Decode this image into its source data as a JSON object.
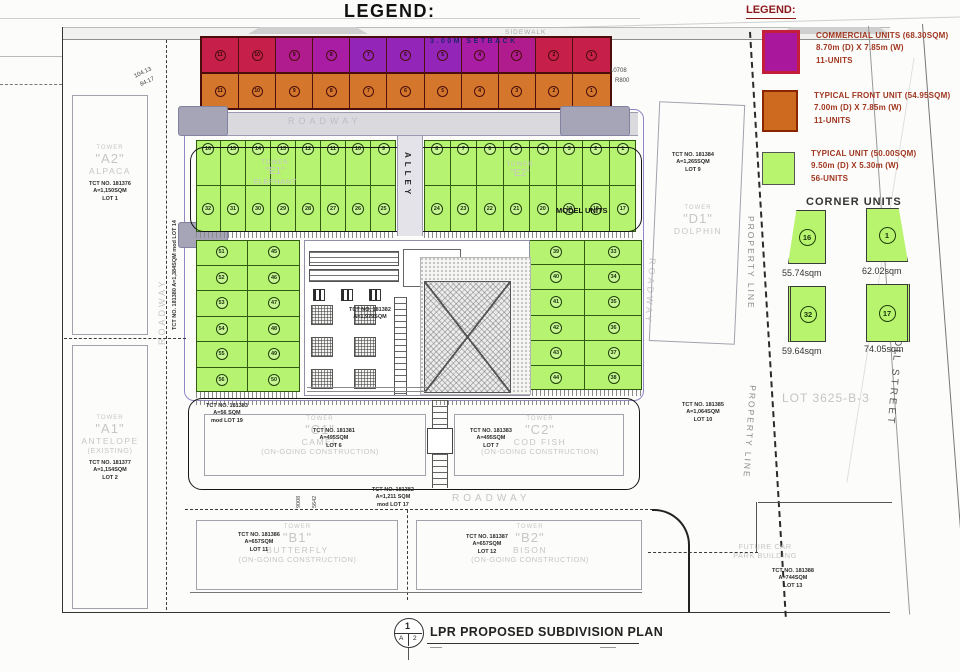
{
  "sheet_title": "LEGEND:",
  "legend": {
    "heading": "LEGEND:",
    "items": [
      {
        "bg": "#a9189c",
        "border": "#c41e3a",
        "l1": "COMMERCIAL UNITS (68.30SQM)",
        "l2": "8.70m (D) X 7.85m (W)",
        "l3": "11-UNITS"
      },
      {
        "bg": "#cd6a1f",
        "border": "#8b2500",
        "l1": "TYPICAL FRONT UNIT (54.95SQM)",
        "l2": "7.00m (D) X 7.85m (W)",
        "l3": "11-UNITS"
      },
      {
        "bg": "#b8f46e",
        "border": "#555555",
        "l1": "TYPICAL UNIT (50.00SQM)",
        "l2": "9.50m (D) X 5.30m (W)",
        "l3": "56-UNITS"
      }
    ],
    "corner_heading": "CORNER UNITS",
    "corner_units": [
      {
        "number": "16",
        "area": "55.74sqm"
      },
      {
        "number": "1",
        "area": "62.02sqm"
      },
      {
        "number": "32",
        "area": "59.64sqm"
      },
      {
        "number": "17",
        "area": "74.05sqm"
      }
    ]
  },
  "plan": {
    "setback": "3.00M SETBACK",
    "sidewalk": "SIDEWALK",
    "roadway": "ROADWAY",
    "alley": "ALLEY",
    "model_units": "MODEL UNITS",
    "property_line": "PROPERTY LINE",
    "street": "DAFFODIL STREET",
    "lot3625": "LOT 3625-B-3",
    "commercial_cells": [
      {
        "n": "11",
        "bg": "#c6204a"
      },
      {
        "n": "10",
        "bg": "#c6204a"
      },
      {
        "n": "9",
        "bg": "#b01c8e"
      },
      {
        "n": "8",
        "bg": "#a81da4"
      },
      {
        "n": "7",
        "bg": "#9326b8"
      },
      {
        "n": "6",
        "bg": "#9326b8"
      },
      {
        "n": "5",
        "bg": "#9326b8"
      },
      {
        "n": "4",
        "bg": "#a81da4"
      },
      {
        "n": "3",
        "bg": "#b01c8e"
      },
      {
        "n": "2",
        "bg": "#c6204a"
      },
      {
        "n": "1",
        "bg": "#c6204a"
      }
    ],
    "front_cells": [
      "11",
      "10",
      "9",
      "8",
      "7",
      "6",
      "5",
      "4",
      "3",
      "2",
      "1"
    ],
    "blocks": {
      "left_top": [
        "16",
        "15",
        "14",
        "13",
        "12",
        "11",
        "10",
        "9"
      ],
      "right_top": [
        "8",
        "7",
        "6",
        "5",
        "4",
        "3",
        "2",
        "1"
      ],
      "left_bottom": [
        "32",
        "31",
        "30",
        "29",
        "28",
        "27",
        "26",
        "25"
      ],
      "right_bottom": [
        "24",
        "23",
        "22",
        "21",
        "20",
        "19",
        "18",
        "17"
      ]
    },
    "strips": {
      "left_outer": [
        "51",
        "52",
        "53",
        "54",
        "55",
        "56"
      ],
      "left_inner": [
        "45",
        "46",
        "47",
        "48",
        "49",
        "50"
      ],
      "right_inner": [
        "39",
        "40",
        "41",
        "42",
        "43",
        "44"
      ],
      "right_outer": [
        "33",
        "34",
        "35",
        "36",
        "37",
        "38"
      ]
    },
    "towers": {
      "a2": {
        "t": "TOWER",
        "q": "\"A2\"",
        "name": "ALPACA",
        "tct": "TCT NO. 181376",
        "area": "A=1,150SQM",
        "lot": "LOT 1"
      },
      "a1": {
        "t": "TOWER",
        "q": "\"A1\"",
        "name": "ANTELOPE",
        "status": "(EXISTING)",
        "tct": "TCT NO. 181377",
        "area": "A=1,154SQM",
        "lot": "LOT 2"
      },
      "d1": {
        "t": "TOWER",
        "q": "\"D1\"",
        "name": "DOLPHIN",
        "tct": "TCT NO. 181384",
        "area": "A=1,265SQM",
        "lot": "LOT 9"
      },
      "c1": {
        "t": "TOWER",
        "q": "\"C1\"",
        "name": "CAMEL",
        "status": "(ON-GOING CONSTRUCTION)",
        "tct": "TCT NO. 181381",
        "area": "A=495SQM",
        "lot": "LOT 6"
      },
      "c2": {
        "t": "TOWER",
        "q": "\"C2\"",
        "name": "COD FISH",
        "status": "(ON-GOING CONSTRUCTION)",
        "tct": "TCT NO. 181383",
        "area": "A=495SQM",
        "lot": "LOT 7"
      },
      "b1": {
        "t": "TOWER",
        "q": "\"B1\"",
        "name": "BUTTERFLY",
        "status": "(ON-GOING CONSTRUCTION)",
        "tct": "TCT NO. 181386",
        "area": "A=657SQM",
        "lot": "LOT 11"
      },
      "b2": {
        "t": "TOWER",
        "q": "\"B2\"",
        "name": "BISON",
        "status": "(ON-GOING CONSTRUCTION)",
        "tct": "TCT NO. 181387",
        "area": "A=657SQM",
        "lot": "LOT 12"
      },
      "e1": {
        "t": "TOWER",
        "q": "\"E1\"",
        "name": "ELEPHANT"
      },
      "e2": {
        "t": "TOWER",
        "q": "\"E2\""
      }
    },
    "tct": {
      "lot19": {
        "l1": "TCT NO. 181383",
        "l2": "A=56 SQM",
        "l3": "mod LOT 19"
      },
      "lot17": {
        "l1": "TCT NO. 181382",
        "l2": "A=1,211 SQM",
        "l3": "mod LOT 17"
      },
      "lot10": {
        "l1": "TCT NO. 181385",
        "l2": "A=1,064SQM",
        "l3": "LOT 10"
      },
      "lot13": {
        "l1": "TCT NO. 181388",
        "l2": "A=744SQM",
        "l3": "LOT 13"
      },
      "lot14": "TCT NO. 181380  A=1,384SQM  mod LOT 14",
      "center": {
        "l1": "TCT NO. 181382",
        "l2": "A=1,979SQM"
      }
    },
    "carpark": {
      "l1": "FUTURE CAR",
      "l2": "PARK BUILDING"
    },
    "dims": {
      "d1": "104.13",
      "d2": "84.17",
      "d3": "10708",
      "d4": "R800",
      "d5": "9008",
      "d6": "5642"
    }
  },
  "footer": {
    "top": "1",
    "left": "A",
    "right": "2",
    "title": "LPR PROPOSED SUBDIVISION PLAN"
  }
}
